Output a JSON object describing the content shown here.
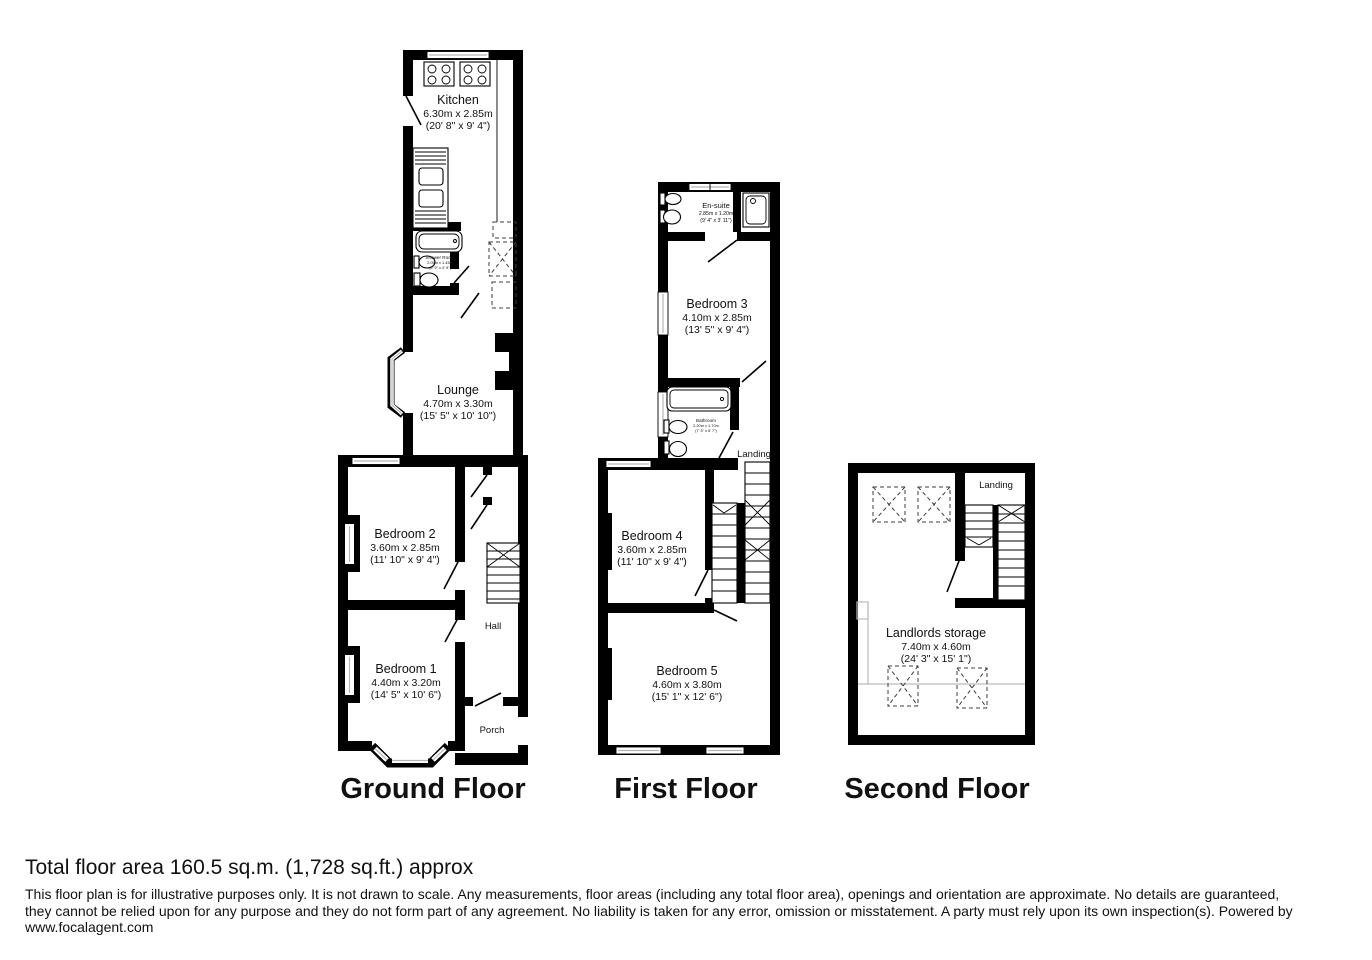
{
  "floors": {
    "ground": {
      "title": "Ground Floor",
      "rooms": {
        "kitchen": {
          "name": "Kitchen",
          "metric": "6.30m x 2.85m",
          "imperial": "(20' 8\" x 9' 4\")"
        },
        "shower_room": {
          "name": "Shower Room",
          "metric": "2.05m x 1.45m",
          "imperial": "(6' 9\" x 4' 9\")"
        },
        "lounge": {
          "name": "Lounge",
          "metric": "4.70m x 3.30m",
          "imperial": "(15' 5\" x 10' 10\")"
        },
        "bedroom_2": {
          "name": "Bedroom 2",
          "metric": "3.60m x 2.85m",
          "imperial": "(11' 10\" x 9' 4\")"
        },
        "bedroom_1": {
          "name": "Bedroom 1",
          "metric": "4.40m x 3.20m",
          "imperial": "(14' 5\" x 10' 6\")"
        },
        "hall": {
          "name": "Hall"
        },
        "porch": {
          "name": "Porch"
        }
      }
    },
    "first": {
      "title": "First Floor",
      "rooms": {
        "en_suite": {
          "name": "En-suite",
          "metric": "2.85m x 1.20m",
          "imperial": "(9' 4\" x 3' 11\")"
        },
        "bedroom_3": {
          "name": "Bedroom 3",
          "metric": "4.10m x 2.85m",
          "imperial": "(13' 5\" x 9' 4\")"
        },
        "bathroom": {
          "name": "Bathroom",
          "metric": "2.20m x 1.70m",
          "imperial": "(7' 3\" x 5' 7\")"
        },
        "landing": {
          "name": "Landing"
        },
        "bedroom_4": {
          "name": "Bedroom 4",
          "metric": "3.60m x 2.85m",
          "imperial": "(11' 10\" x 9' 4\")"
        },
        "bedroom_5": {
          "name": "Bedroom 5",
          "metric": "4.60m x 3.80m",
          "imperial": "(15' 1\" x 12' 6\")"
        }
      }
    },
    "second": {
      "title": "Second Floor",
      "rooms": {
        "landing": {
          "name": "Landing"
        },
        "landlords_storage": {
          "name": "Landlords storage",
          "metric": "7.40m x 4.60m",
          "imperial": "(24' 3\" x 15' 1\")"
        }
      }
    }
  },
  "footer": {
    "total_area": "Total floor area 160.5 sq.m. (1,728 sq.ft.) approx",
    "disclaimer_line1": "This floor plan is for illustrative purposes only. It is not drawn to scale. Any measurements, floor areas (including any total floor area), openings and orientation are approximate. No details are guaranteed,",
    "disclaimer_line2": "they cannot be relied upon for any purpose and they do not form part of any agreement. No liability is taken for any error, omission or misstatement. A party must rely upon its own inspection(s). Powered by",
    "disclaimer_line3": "www.focalagent.com"
  },
  "colors": {
    "wall": "#000000",
    "background": "#ffffff",
    "window_glass": "#bdbdbd"
  }
}
